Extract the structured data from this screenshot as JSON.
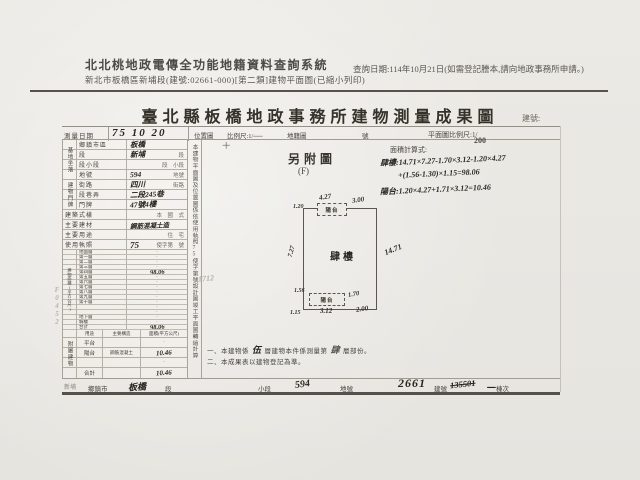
{
  "system": {
    "title": "北北桃地政電傳全功能地籍資料查詢系統",
    "subtitle": "新北市板橋區新埔段(建號:02661-000)[第二類]建物平面圖(已縮小列印)",
    "query_date": "查詢日期:114年10月21日(如需登記謄本,請向地政事務所申請。)"
  },
  "doc": {
    "title": "臺北縣板橋地政事務所建物測量成果圖",
    "serial_label": "建號:",
    "survey_date_label": "測量日期",
    "survey_date": "75 10 20",
    "location_label": "位置圖",
    "location_scale": "比例尺:1/──",
    "cadastral_label": "地籍圖",
    "sheet_label": "號",
    "plan_scale_label": "平面圖比例尺:1/",
    "plan_scale": "200"
  },
  "site": {
    "group": "基地坐落",
    "rows": [
      {
        "label": "鄉鎮市區",
        "value": "板橋",
        "suffix": ""
      },
      {
        "label": "段",
        "value": "新埔",
        "suffix": "段"
      },
      {
        "label": "段小段",
        "value": "",
        "suffix": "段　小段"
      },
      {
        "label": "地號",
        "value": "594",
        "suffix": "地號"
      }
    ]
  },
  "address": {
    "group": "建物門牌",
    "rows": [
      {
        "label": "街路",
        "value": "四川",
        "suffix": "街路"
      },
      {
        "label": "段巷弄",
        "value": "二段245巷",
        "suffix": ""
      },
      {
        "label": "門牌",
        "value": "47號4樓",
        "suffix": ""
      }
    ]
  },
  "info_rows": [
    {
      "label": "建築式樣",
      "value": "",
      "suffix": "本　國　式"
    },
    {
      "label": "主要建材",
      "value": "鋼筋混凝土造",
      "suffix": ""
    },
    {
      "label": "主要用途",
      "value": "",
      "suffix": "住　宅"
    },
    {
      "label": "使用執照",
      "value": "75",
      "suffix": "使字第　號"
    }
  ],
  "floor_area": {
    "group": "建物面積(平方公尺)",
    "rows": [
      {
        "label": "地面層",
        "value": "·"
      },
      {
        "label": "第一層",
        "value": "·"
      },
      {
        "label": "第二層",
        "value": "·"
      },
      {
        "label": "第三層",
        "value": "·"
      },
      {
        "label": "第四層",
        "value": "98.06"
      },
      {
        "label": "第五層",
        "value": "·"
      },
      {
        "label": "第六層",
        "value": "·"
      },
      {
        "label": "第七層",
        "value": "·"
      },
      {
        "label": "第八層",
        "value": "·"
      },
      {
        "label": "第九層",
        "value": "·"
      },
      {
        "label": "第十層",
        "value": "·"
      },
      {
        "label": "",
        "value": "·"
      },
      {
        "label": "",
        "value": "·"
      },
      {
        "label": "地下層",
        "value": "·"
      },
      {
        "label": "騎樓",
        "value": "·"
      },
      {
        "label": "合計",
        "value": "98.06"
      }
    ]
  },
  "annex": {
    "group": "附屬建物",
    "headers": [
      "用途",
      "主要構造",
      "面積(平方公尺)"
    ],
    "rows": [
      {
        "use": "平台",
        "structure": "",
        "area": "·"
      },
      {
        "use": "陽台",
        "structure": "鋼筋混凝土",
        "area": "10.46"
      },
      {
        "use": "",
        "structure": "",
        "area": "·"
      },
      {
        "use": "合計",
        "structure": "",
        "area": "10.46"
      }
    ]
  },
  "side_note": "本建物平面圖及位置圖係依使用執照75使字第號設計圖竣工平面圖轉繪計算",
  "margin_scribble": "F0452",
  "calc": {
    "label": "面積計算式:",
    "line1": "肆樓:14.71×7.27-1.70×3.12-1.20×4.27",
    "line2": "+(1.56-1.30)×1.15=98.06",
    "line3": "陽台:1.20×4.27+1.71×3.12=10.46"
  },
  "drawing": {
    "attach": "另附圖",
    "attach_sub": "(F)",
    "main_label": "肆樓",
    "balcony_top": "陽台",
    "balcony_bottom": "陽台",
    "dim_top": "4.27",
    "dim_top_right": "3.00",
    "dim_left_top": "1.20",
    "dim_left_mid": "7.27",
    "dim_right": "14.71",
    "dim_b_left": "1.56",
    "dim_b_right": "1.70",
    "dim_b_bottom": "3.12",
    "dim_b_bl": "1.15",
    "dim_b_br": "2.00",
    "stray": "1712"
  },
  "notes": {
    "n1a": "一、本建物係",
    "n1b": "伍",
    "n1c": "層建物本件係測量第",
    "n1d": "肆",
    "n1e": "層部份。",
    "n2": "二、本成果表以建物登記為準。"
  },
  "footer": {
    "corner": "新埔",
    "c1_label": "鄉鎮市",
    "c1_value": "板橋",
    "c2_label": "段",
    "c3_label": "小段",
    "c3_value": "594",
    "c4_label": "地號",
    "c4_value": "2661",
    "c5_label": "建號",
    "c5_value": "135501",
    "c6_value": "一",
    "c6_label": "棟次"
  }
}
